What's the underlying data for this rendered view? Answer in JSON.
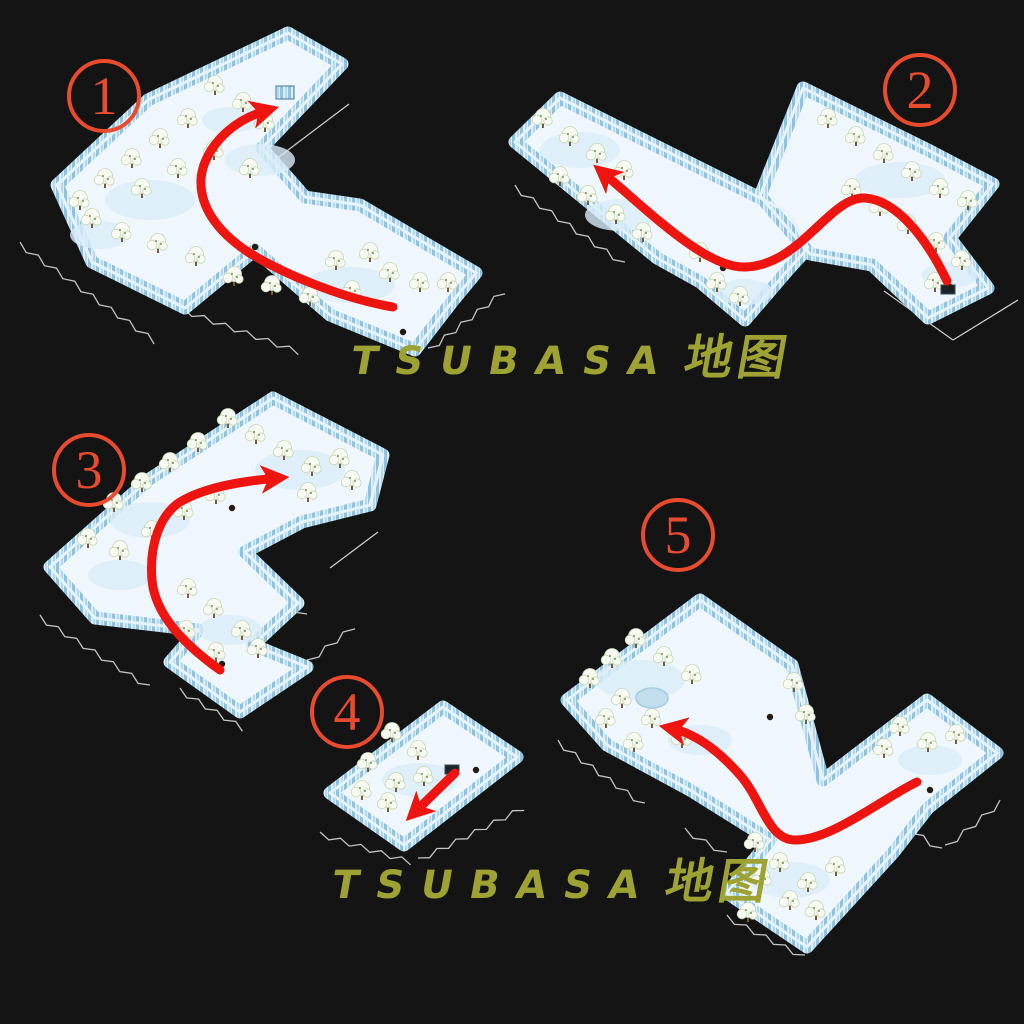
{
  "background_color": "#141414",
  "accent": {
    "badge_color": "#e84b2e",
    "route_color": "#ee1410",
    "outline_color": "#ffffff",
    "watermark_color": "#9ea233"
  },
  "watermark": {
    "latin": "TSUBASA",
    "cjk": "地图",
    "full_text": "TSUBASA 地图",
    "occurrences": 2
  },
  "maps": [
    {
      "label": "1",
      "name": "snow-map-1"
    },
    {
      "label": "2",
      "name": "snow-map-2"
    },
    {
      "label": "3",
      "name": "snow-map-3"
    },
    {
      "label": "4",
      "name": "snow-map-4"
    },
    {
      "label": "5",
      "name": "snow-map-5"
    }
  ]
}
